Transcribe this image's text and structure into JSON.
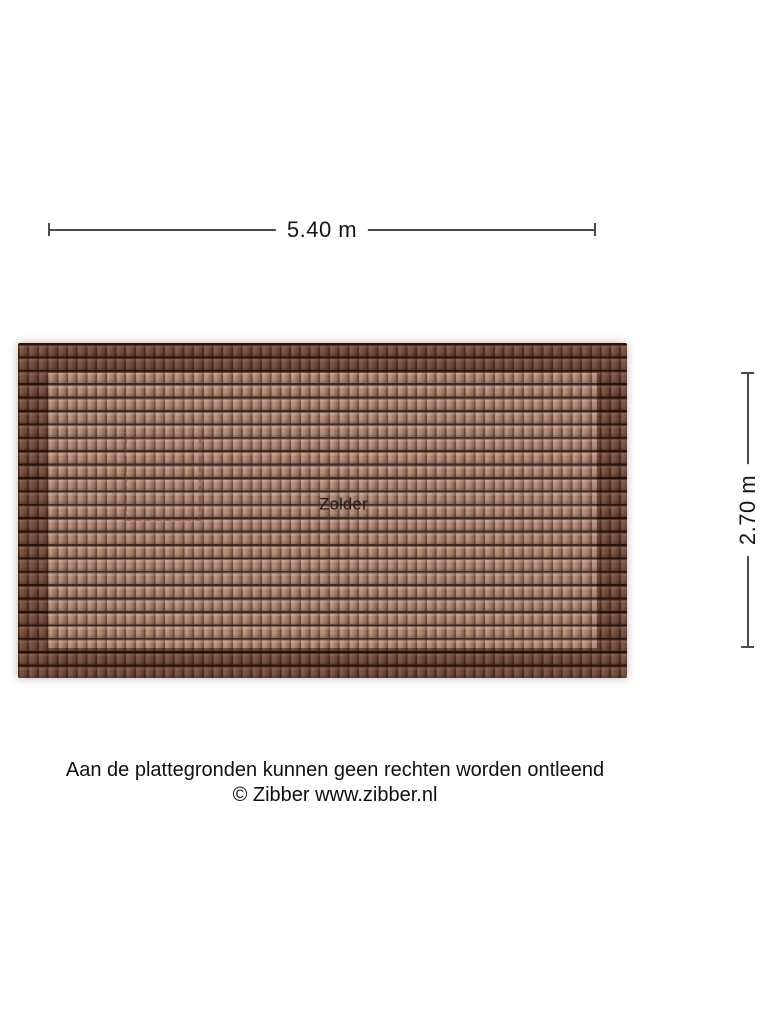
{
  "page": {
    "background_color": "#ffffff"
  },
  "floorplan": {
    "room_label": "Zolder",
    "dimensions": {
      "width": {
        "label": "5.40 m"
      },
      "height": {
        "label": "2.70 m"
      }
    },
    "roof": {
      "texture": "roof-tiles",
      "colors": {
        "tile_color": "#a3745e",
        "tile_highlight": "#b78873",
        "groove_color": "#5e3b2c",
        "row_shadow_color": "#23120c",
        "edge_shade_color": "rgba(44,19,9,0.40)",
        "inner_highlight": "rgba(255,255,255,0.10)",
        "dimension_line_color": "#4a4a4a"
      }
    }
  },
  "footer": {
    "disclaimer": "Aan de plattegronden kunnen geen rechten worden ontleend",
    "copyright": "© Zibber www.zibber.nl"
  }
}
